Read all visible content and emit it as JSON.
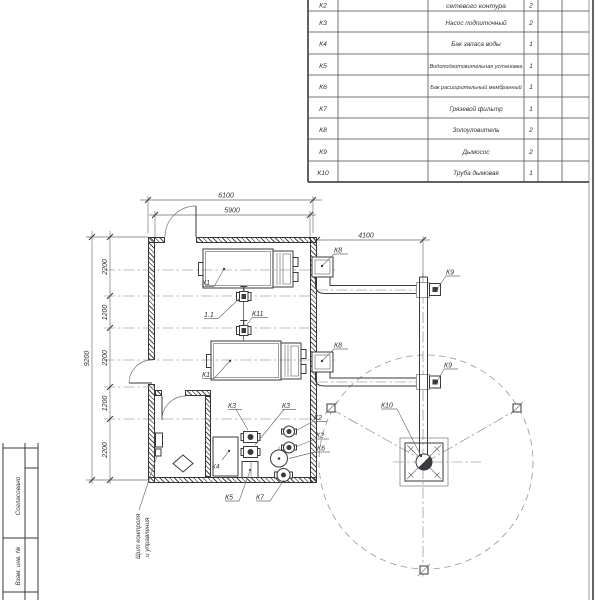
{
  "colors": {
    "ink": "#3a3a3f",
    "thin_line": "#6d6d72",
    "paper": "#ffffff"
  },
  "spec_table": {
    "rows": [
      {
        "pos": "К2",
        "name": "сетевого контура",
        "qty": "2"
      },
      {
        "pos": "К3",
        "name": "Насос подпиточный",
        "qty": "2"
      },
      {
        "pos": "К4",
        "name": "Бак запаса воды",
        "qty": "1"
      },
      {
        "pos": "К5",
        "name": "Водоподготовительная установка",
        "qty": "1"
      },
      {
        "pos": "К6",
        "name": "Бак расширительный мембранный",
        "qty": "1"
      },
      {
        "pos": "К7",
        "name": "Грязевой фильтр",
        "qty": "1"
      },
      {
        "pos": "К8",
        "name": "Золоуловитель",
        "qty": "2"
      },
      {
        "pos": "К9",
        "name": "Дымосос",
        "qty": "2"
      },
      {
        "pos": "К10",
        "name": "Труба дымовая",
        "qty": "1"
      }
    ]
  },
  "dims": {
    "top_outer": "6100",
    "top_inner": "5900",
    "flue_offset": "4100",
    "overall_height": "9200",
    "chain": [
      "2200",
      "1200",
      "2200",
      "1200",
      "2200"
    ]
  },
  "equipment_labels": {
    "boiler_top": "К1",
    "boiler_bottom": "К1",
    "valve_11": "1.1",
    "valve_k11": "К11",
    "ash_top": "К8",
    "ash_bottom": "К8",
    "fan_top": "К9",
    "fan_bottom": "К9",
    "stack_k10": "К10",
    "pump_k3_a": "К3",
    "pump_k3_b": "К3",
    "pump_k2_a": "К2",
    "pump_k2_b": "К2",
    "tank_k6": "К6",
    "tank_k4": "К4",
    "water_k5": "К5",
    "filter_k7": "К7"
  },
  "callout": {
    "line1": "Щит контроля",
    "line2": "и управления"
  },
  "title_block": {
    "agreed": "Согласовано",
    "vzam": "Взам. инв. №"
  }
}
